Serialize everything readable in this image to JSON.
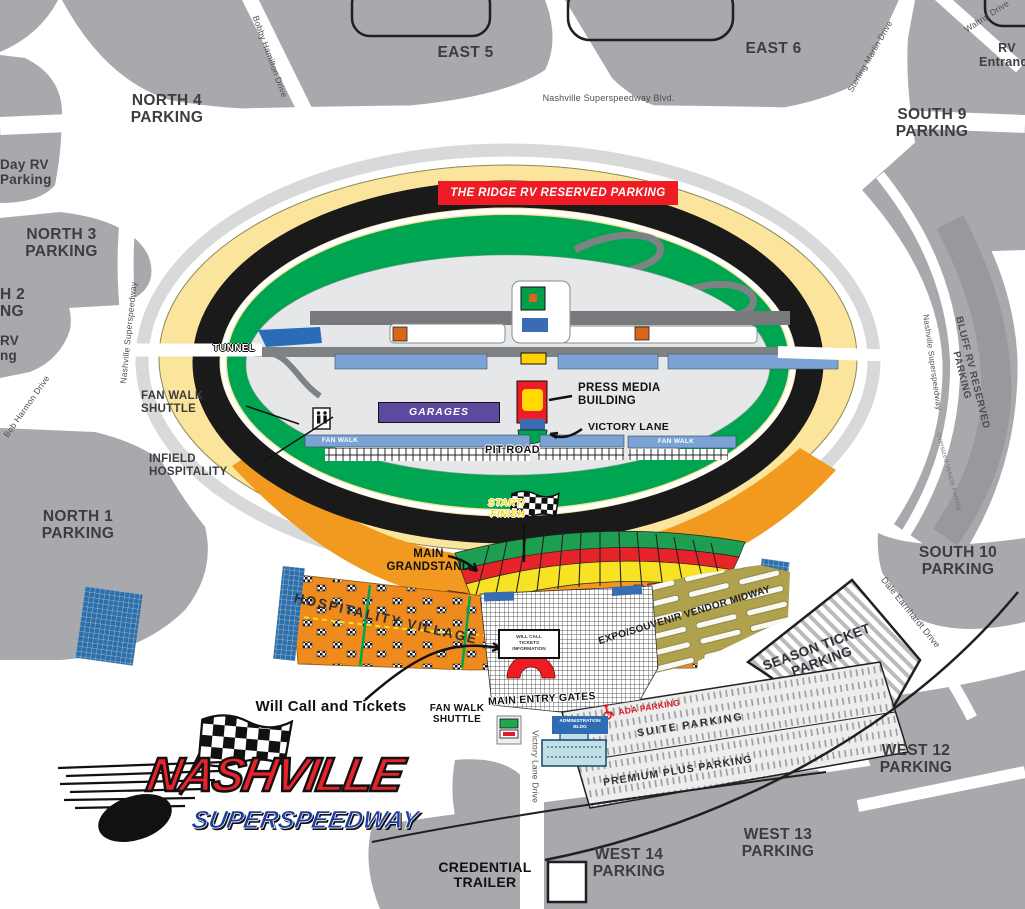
{
  "colors": {
    "parking_gray": "#a7a9ac",
    "apron_yellow": "#fbe49b",
    "infield_green": "#00a551",
    "track_black": "#1a1a1a",
    "grandstand_orange": "#f29a1f",
    "seat_green": "#1d9e50",
    "seat_red": "#e8242b",
    "seat_yellow": "#f7e223",
    "midway_olive": "#b0a14c",
    "banner_red": "#ee1c25",
    "garages_purple": "#5c4a9f",
    "fan_walk_blue": "#7aa3d4",
    "building_blue": "#3a6cb4",
    "logo_red": "#e8222a",
    "logo_blue": "#1c3ca0"
  },
  "parking": {
    "north4": "NORTH 4\nPARKING",
    "east5": "EAST 5",
    "east6": "EAST 6",
    "rv_entrance": "RV\nEntrance",
    "south9": "SOUTH 9\nPARKING",
    "day_rv": "Day RV\nParking",
    "north3": "NORTH 3\nPARKING",
    "north2_cut": "H 2\nNG",
    "rv_cut": "RV\nng",
    "north1": "NORTH 1\nPARKING",
    "south10": "SOUTH 10\nPARKING",
    "west12": "WEST 12\nPARKING",
    "west13": "WEST 13\nPARKING",
    "west14": "WEST 14\nPARKING",
    "season_ticket": "SEASON TICKET\nPARKING",
    "suite": "SUITE PARKING",
    "premium": "PREMIUM PLUS PARKING",
    "ada": "ADA PARKING",
    "bluff": "BLUFF RV RESERVED PARKING",
    "oversized": "Oversized Vehicle Parking",
    "ridge": "THE RIDGE RV RESERVED PARKING"
  },
  "roads": {
    "bobby_hamilton": "Bobby Hamilton Drive",
    "sterling_marlin": "Sterling Marlin Drive",
    "waltrip": "Waltrip Drive",
    "nss_blvd": "Nashville Superspeedway Blvd.",
    "nss_left": "Nashville Superspeedway",
    "nss_right": "Nashville Superspeedway",
    "bob_harmon": "Bob Harmon Drive",
    "dale_earnhardt": "Dale Earnhardt Drive",
    "victory_lane_drive": "Victory Lane Drive"
  },
  "track": {
    "tunnel": "TUNNEL",
    "start_finish": "START/\nFINISH",
    "main_grandstand": "MAIN\nGRANDSTAND",
    "pit_road": "PIT ROAD",
    "fan_walk_left": "FAN WALK",
    "fan_walk_right": "FAN WALK",
    "garages": "GARAGES",
    "press_media": "PRESS MEDIA\nBUILDING",
    "victory_lane": "VICTORY LANE",
    "fan_walk_shuttle": "FAN WALK\nSHUTTLE",
    "infield_hospitality": "INFIELD\nHOSPITALITY"
  },
  "entry": {
    "hospitality_village": "HOSPITALITY VILLAGE",
    "will_call": "Will Call and Tickets",
    "will_call_box": "WILL CALL\nTICKETS\nINFORMATION",
    "main_entry_gates": "MAIN ENTRY GATES",
    "fan_walk_shuttle": "FAN WALK\nSHUTTLE",
    "expo": "EXPO/SOUVENIR VENDOR MIDWAY",
    "admin": "ADMINISTRATION\nBLDG",
    "credential": "CREDENTIAL\nTRAILER"
  },
  "logo": {
    "line1": "NASHVILLE",
    "line2": "SUPERSPEEDWAY"
  }
}
